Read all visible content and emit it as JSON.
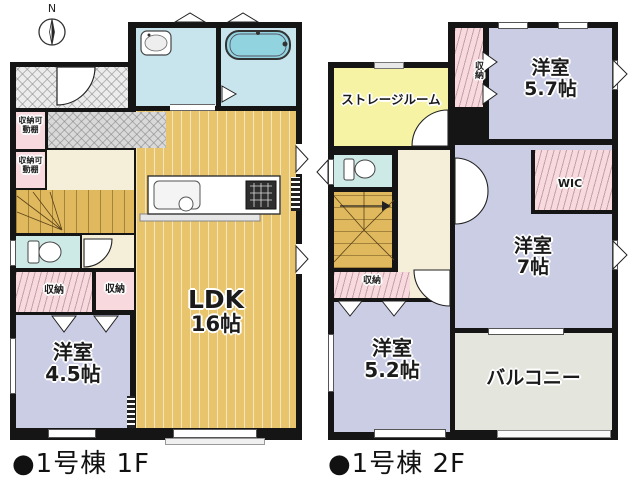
{
  "compass": {
    "north_label": "N"
  },
  "floor1": {
    "caption": "●1号棟 1F",
    "ldk": {
      "name": "LDK",
      "size": "16帖"
    },
    "western_room": {
      "name": "洋室",
      "size": "4.5帖"
    },
    "closet_shelf_upper": "収納可動棚",
    "closet_shelf_lower": "収納可動棚",
    "closet_left": "収納",
    "closet_right": "収納"
  },
  "floor2": {
    "caption": "●1号棟 2F",
    "storage_room": "ストレージルーム",
    "western_room_57": {
      "name": "洋室",
      "size": "5.7帖"
    },
    "western_room_7": {
      "name": "洋室",
      "size": "7帖"
    },
    "western_room_52": {
      "name": "洋室",
      "size": "5.2帖"
    },
    "balcony": "バルコニー",
    "wic": "WIC",
    "closet_top": "収納",
    "closet_hall": "収納"
  },
  "colors": {
    "wall": "#151515",
    "room_purple": "#cbcde5",
    "ldk_tan": "#e8c56c",
    "closet_pink": "#f7d9de",
    "storage_yellow": "#f6f3a4",
    "water_blue": "#c8e5ee",
    "balcony_gray": "#e4e6dd"
  }
}
